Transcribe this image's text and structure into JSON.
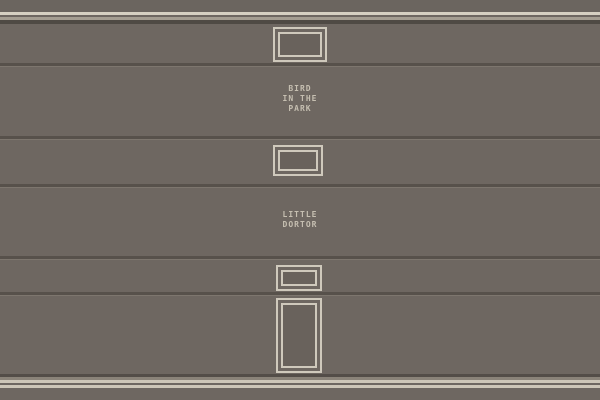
{
  "scene": {
    "description": "pixel-art interior wall with cornice, skirting, panel grooves, empty picture frames and painted labels",
    "labels": {
      "bird_in_the_park": {
        "line1": "BIRD",
        "line2": "IN THE",
        "line3": "PARK"
      },
      "little_dortor": {
        "line1": "LITTLE",
        "line2": "DORTOR"
      }
    },
    "frames": [
      {
        "name": "small landscape frame (top)",
        "orientation": "landscape"
      },
      {
        "name": "small landscape frame (middle)",
        "orientation": "landscape"
      },
      {
        "name": "small landscape frame (lower)",
        "orientation": "landscape"
      },
      {
        "name": "tall portrait frame (bottom)",
        "orientation": "portrait"
      }
    ]
  },
  "colors": {
    "wall": "#6e6761",
    "wall_top": "#6b655f",
    "trim_bright": "#d6d0c2",
    "trim_mid": "#a59e92",
    "trim_dark": "#4f4a44",
    "groove_dark": "#57514b",
    "groove_edge": "#7d766e",
    "frame_border": "#cfc9bc",
    "frame_interior": "#69625c",
    "label_text": "#c6bfb1",
    "skirt_dark": "#534d48",
    "skirt_mid": "#8a8379",
    "skirt_bright": "#cdc6b8"
  }
}
